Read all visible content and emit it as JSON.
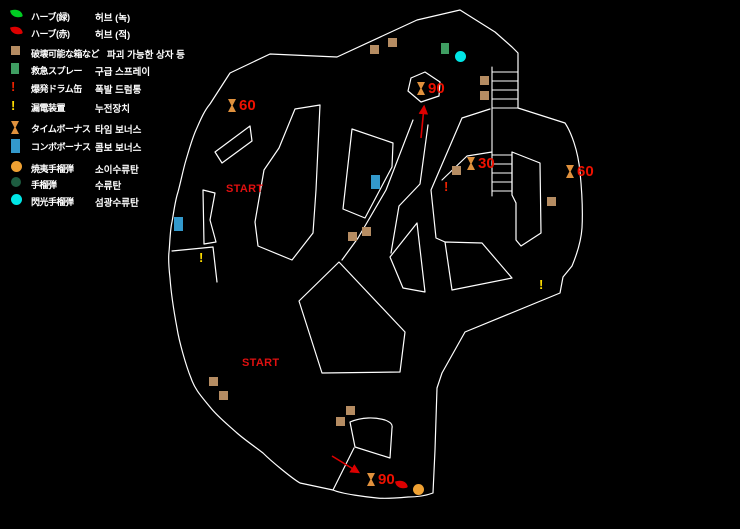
{
  "legend": {
    "items": [
      {
        "icon": "herb-green",
        "jp": "ハーブ(緑)",
        "kr": "허브 (녹)"
      },
      {
        "icon": "herb-red",
        "jp": "ハーブ(赤)",
        "kr": "허브 (적)"
      },
      {
        "icon": "box",
        "jp": "破壊可能な箱など",
        "kr": "파괴 가능한 상자 등"
      },
      {
        "icon": "spray",
        "jp": "救急スプレー",
        "kr": "구급 스프레이"
      },
      {
        "icon": "drum",
        "glyph": "!",
        "jp": "爆発ドラム缶",
        "kr": "폭발 드럼통"
      },
      {
        "icon": "leak",
        "glyph": "!",
        "jp": "漏電装置",
        "kr": "누전장치"
      },
      {
        "icon": "time",
        "jp": "タイムボーナス",
        "kr": "타임 보너스"
      },
      {
        "icon": "combo",
        "jp": "コンボボーナス",
        "kr": "콤보 보너스"
      },
      {
        "icon": "fire",
        "jp": "焼夷手榴弾",
        "kr": "소이수류탄"
      },
      {
        "icon": "grenade",
        "jp": "手榴弾",
        "kr": "수류탄"
      },
      {
        "icon": "flash",
        "jp": "閃光手榴弾",
        "kr": "섬광수류탄"
      }
    ]
  },
  "map": {
    "start_labels": [
      {
        "x": 226,
        "y": 183,
        "text": "START"
      },
      {
        "x": 242,
        "y": 357,
        "text": "START"
      }
    ],
    "time_bonuses": [
      {
        "x": 228,
        "y": 99,
        "value": "60"
      },
      {
        "x": 417,
        "y": 82,
        "value": "90"
      },
      {
        "x": 467,
        "y": 157,
        "value": "30"
      },
      {
        "x": 566,
        "y": 165,
        "value": "60"
      },
      {
        "x": 367,
        "y": 473,
        "value": "90"
      }
    ],
    "items": [
      {
        "type": "box",
        "x": 370,
        "y": 45
      },
      {
        "type": "box",
        "x": 388,
        "y": 38
      },
      {
        "type": "box",
        "x": 480,
        "y": 76
      },
      {
        "type": "box",
        "x": 480,
        "y": 91
      },
      {
        "type": "box",
        "x": 452,
        "y": 166
      },
      {
        "type": "box",
        "x": 547,
        "y": 197
      },
      {
        "type": "box",
        "x": 362,
        "y": 227
      },
      {
        "type": "box",
        "x": 348,
        "y": 232
      },
      {
        "type": "box",
        "x": 209,
        "y": 377
      },
      {
        "type": "box",
        "x": 219,
        "y": 391
      },
      {
        "type": "box",
        "x": 346,
        "y": 406
      },
      {
        "type": "box",
        "x": 336,
        "y": 417
      },
      {
        "type": "spray",
        "x": 441,
        "y": 43
      },
      {
        "type": "flash",
        "x": 455,
        "y": 51
      },
      {
        "type": "combo",
        "x": 174,
        "y": 217
      },
      {
        "type": "combo",
        "x": 371,
        "y": 175
      },
      {
        "type": "leak",
        "glyph": "!",
        "x": 199,
        "y": 252
      },
      {
        "type": "leak",
        "glyph": "!",
        "x": 539,
        "y": 279
      },
      {
        "type": "drum",
        "glyph": "!",
        "x": 444,
        "y": 181
      },
      {
        "type": "herb-red",
        "x": 396,
        "y": 480
      },
      {
        "type": "fire",
        "x": 413,
        "y": 484
      }
    ]
  },
  "colors": {
    "background": "#000000",
    "walls": "#ffffff",
    "red_text": "#ee1100",
    "arrow": "#dd0000",
    "box": "#b58c62",
    "spray": "#3f9e62",
    "combo": "#3399cc",
    "time_bonus": "#e0913d",
    "incendiary": "#efa133",
    "grenade": "#1d5c40",
    "flash": "#00e6e6",
    "herb_green": "#00cc22",
    "herb_red": "#dd0000",
    "leak": "#ffdd00",
    "drum": "#ee2200"
  }
}
